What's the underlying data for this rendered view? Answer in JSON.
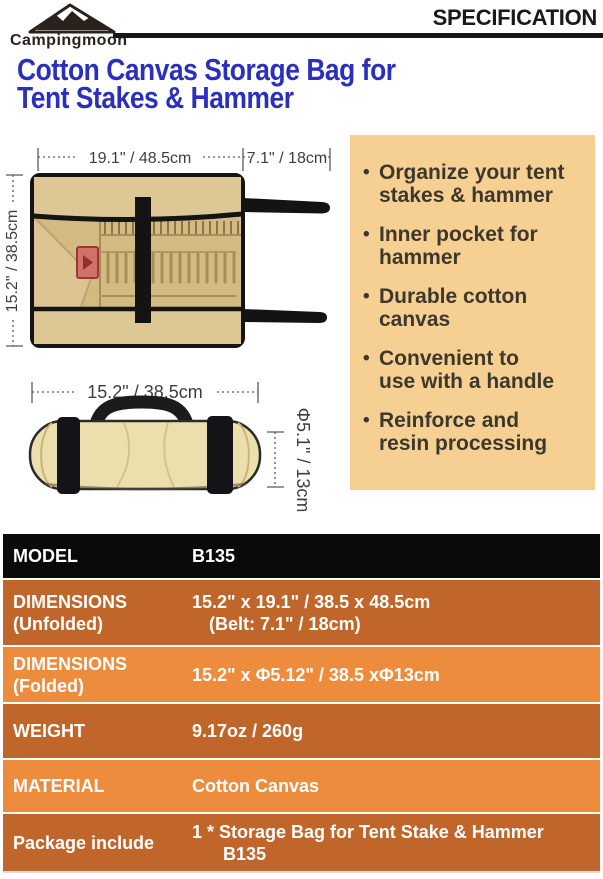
{
  "brand": {
    "name": "Campingmoon"
  },
  "header": {
    "title": "SPECIFICATION"
  },
  "product_title": {
    "line1": "Cotton Canvas Storage Bag for",
    "line2": "Tent Stakes & Hammer"
  },
  "figures": {
    "unfolded": {
      "width_label": "19.1\" / 48.5cm",
      "belt_label": "7.1\" / 18cm",
      "height_label": "15.2\" / 38.5cm"
    },
    "folded": {
      "width_label": "15.2\" / 38.5cm",
      "diameter_label": "Φ5.1\" / 13cm"
    }
  },
  "features": {
    "bullet": "•",
    "items": [
      "Organize your tent\nstakes & hammer",
      "Inner pocket for\nhammer",
      "Durable cotton\ncanvas",
      "Convenient to\nuse with a handle",
      "Reinforce and\nresin processing"
    ]
  },
  "spec_table": {
    "rows": [
      {
        "label": "MODEL",
        "value": "B135"
      },
      {
        "label": "DIMENSIONS",
        "label2": "(Unfolded)",
        "value": "15.2\" x 19.1\" / 38.5 x 48.5cm",
        "value2": "(Belt: 7.1\" / 18cm)"
      },
      {
        "label": "DIMENSIONS",
        "label2": "(Folded)",
        "value": "15.2\" x Φ5.12\" / 38.5 xΦ13cm"
      },
      {
        "label": "WEIGHT",
        "value": "9.17oz / 260g"
      },
      {
        "label": "MATERIAL",
        "value": "Cotton Canvas"
      },
      {
        "label": "Package include",
        "value": "1 * Storage Bag for Tent Stake & Hammer",
        "value2": "B135"
      }
    ]
  },
  "colors": {
    "title_blue": "#2a2fc0",
    "panel_tan": "#f5d092",
    "table_row_dark": "#c1662b",
    "table_row_light": "#ee8c3e",
    "table_row_model": "#0a0a0a",
    "bag_canvas_tan": "#d8c28e",
    "patch_red": "#d0726a"
  }
}
